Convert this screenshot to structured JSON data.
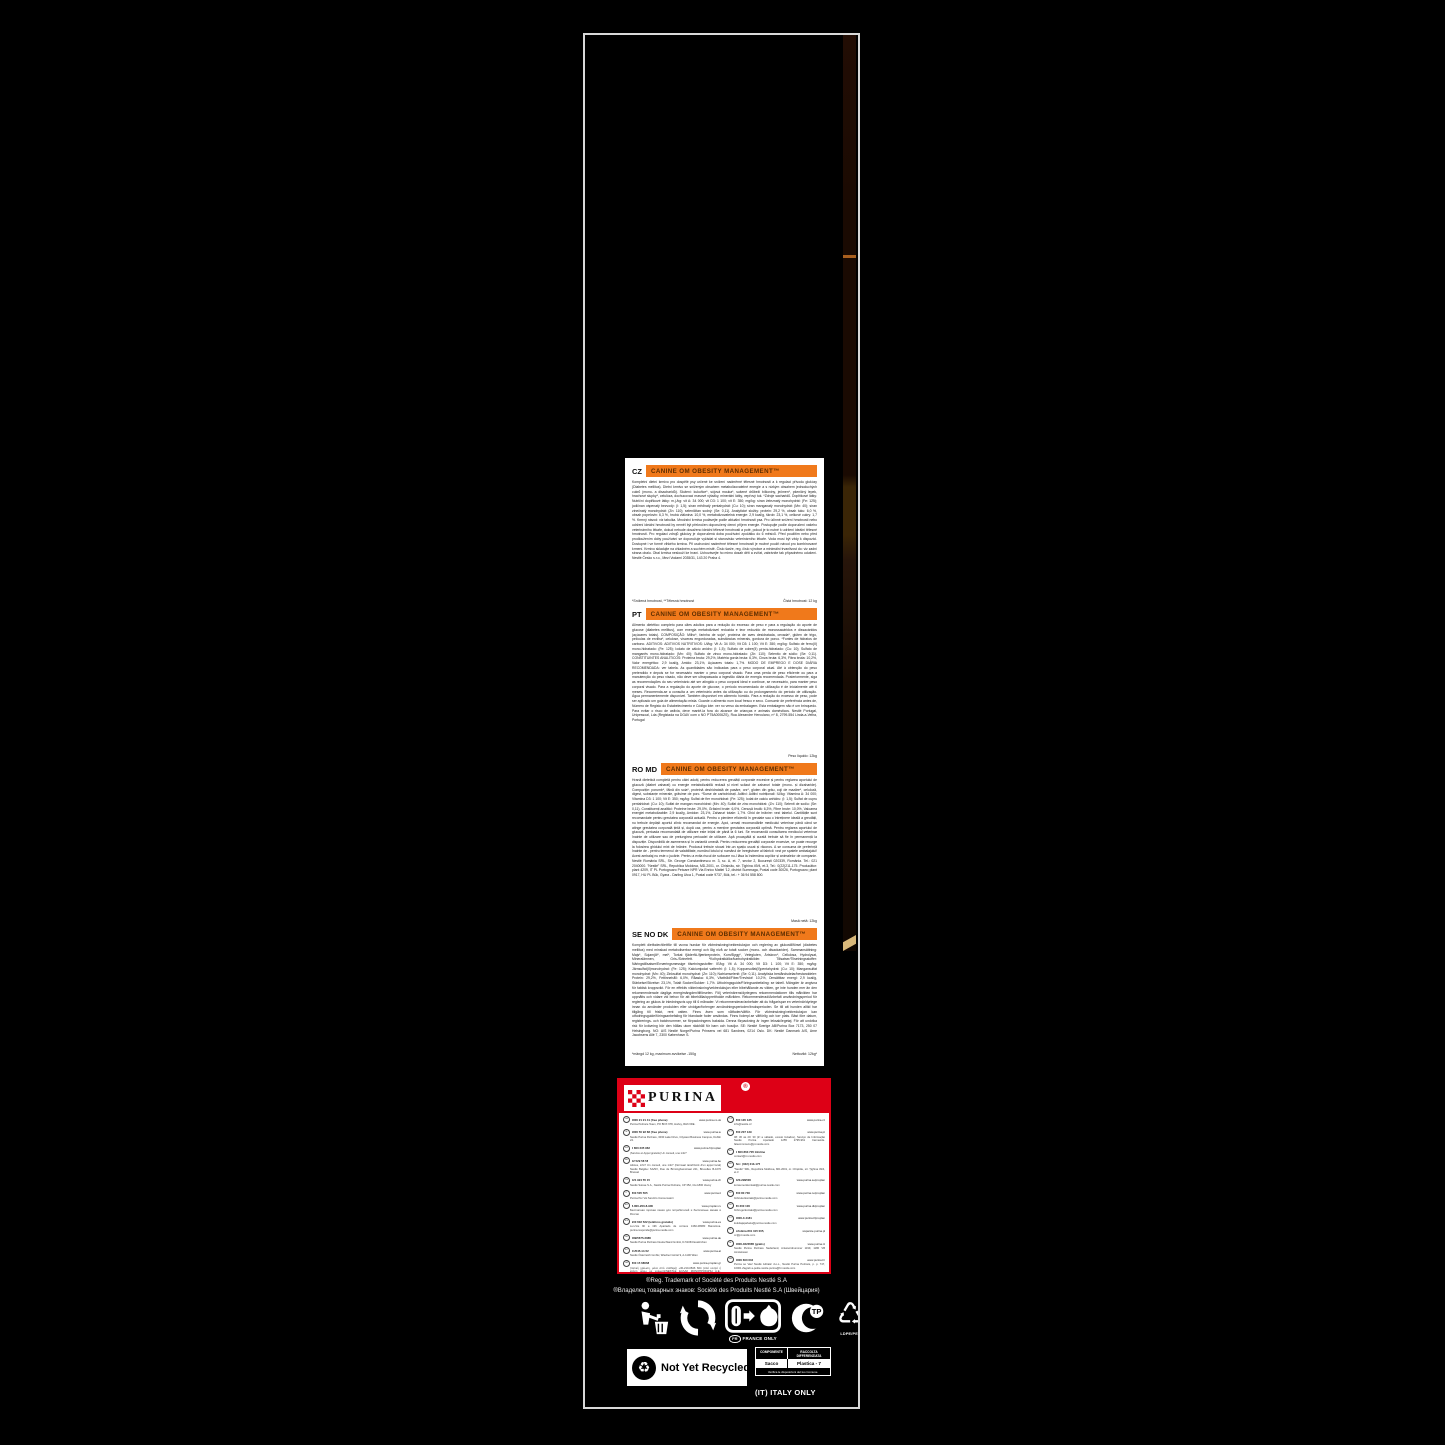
{
  "colors": {
    "accent_orange": "#f0791b",
    "brand_red": "#dd0016",
    "edge_brown": "#3a2506",
    "edge_tan": "#d9b87a"
  },
  "package": {
    "sections": [
      {
        "code": "CZ",
        "title": "CANINE OM OBESITY MANAGEMENT™",
        "body": "Kompletní dietní krmivo pro dospělé psy určené ke snížení nadměrné tělesné hmotnosti a k regulaci přívodu glukózy (Diabetes mellitus). Dietní krmivo se sníženým obsahem metabolizovatelné energie a s nízkým obsahem jednoduchých cukrů (mono- a disacharidů). Složení: kukuřice*, sójová mouka*, sušené drůbeží bílkoviny, ječmen*, pšeničný lepek, hrachové slupky*, celulóza, dochucovací masové výtažky, minerální látky, vepřový tuk. *Zdroje sacharidů. Doplňkové látky: Nutriční doplňkové látky: m.j./kg: vit A: 34 000; vit D3: 1 100; vit E: 350; mg/kg: síran železnatý monohydrát: (Fe: 125); jodičnan vápenatý bezvodý: (I: 1,5); síran měďnatý pentahydrát: (Cu: 10); síran manganatý monohydrát: (Mn: 40); síran zinečnatý monohydrát: (Zn: 110); seleničitan sodný: (Se: 0,11). Analytické složky: protein: 29,2 %, obsah tuku: 6,0 %, obsah popelovin: 6,3 %, hrubá vláknina: 10,0 %, metabolizovatelná energie: 2,9 kcal/g, škrob: 23,1 %, celkové cukry: 1,7 %. Krmný návod: viz tabulka. Množství krmiva podávejte podle aktuální hmotnosti psa. Pro účinné snížení hmotnosti nebo udržení ideální hmotnosti by neměl být překročen doporučený denní příjem energie. Postupujte podle doporučení vašeho veterinárního lékaře, dokud nebude dosaženo ideální tělesné hmotnosti a poté, pokud je to nutné k udržení ideální tělesné hmotnosti. Pro regulaci zdrojů glukózy je doporučená doba používání zpočátku do 6 měsíců. Před použitím nebo před prodloužením doby používání se doporučuje vyžádat si stanovisko veterinárního lékaře. Voda musí být vždy k dispozici. Dostupné i ve formě vlhkého krmiva. Při uschování nadměrné tělesné hmotnosti je možné použít návod pro kombinované krmení. Krmivo skladujte na chladném a suchém místě. Číslo šarže, reg. číslo výrobce a minimální trvanlivost do: viz zadní strana obalu. Obal krmiva neslouží ke hraní. Uchovávejte ho mimo dosah dětí a zvířat, zabráníte tak případnému udušení. Nestlé Česko s.r.o., Mezi Vodami 2035/31, 143 20 Praha 4.",
        "footnote": "*Snížená hmotnost, **Tělesná hmotnost",
        "weight": "Čistá hmotnost: 12 kg"
      },
      {
        "code": "PT",
        "title": "CANINE OM OBESITY MANAGEMENT™",
        "body": "Alimento dietético completo para cães adultos para a redução do excesso de peso e para a regulação do aporte de glucose (diabetes mellitus), com energia metabolizável reduzida e teor reduzido de monossacáridos e dissacáridos (açúcares totais). COMPOSIÇÃO: Milho*, farinha de soja*, proteína de aves desidratada, cevada*, glúten de trigo, películas de ervilha*, celulose, vísceras engorduradas, substâncias minerais, gordura de porco. *Fontes de hidratos de carbono. ADITIVOS: ADITIVOS NUTRITIVOS: UI/kg: Vit A: 34 000; Vit D3: 1 100; Vit E: 350; mg/kg: Sulfato de ferro(II) mono-hidratado: (Fe: 125); Iodato de cálcio anidro: (I: 1,5); Sulfato de cobre(II) penta-hidratado: (Cu: 10); Sulfato de manganês mono-hidratado: (Mn: 40); Sulfato de zinco mono-hidratado: (Zn: 110); Selenito de sódio: (Se: 0,11). CONSTITUINTES ANALÍTICOS: Proteína bruta: 29,2%, Matéria gorda bruta: 6,3%, Cinza bruta: 6,3%, Fibra bruta: 10,2%, Valor energético: 2,9 kcal/g, Amido: 23,1%, Açúcares totais: 1,7%. MODO DE EMPREGO E DOSE DIÁRIA RECOMENDADA: ver tabela. As quantidades são indicadas para o peso corporal atual. Até à obtenção do peso pretendido e depois se for necessário manter o peso corporal visado. Para uma perda de peso eficiente ou para a manutenção do peso visado, não deve ser ultrapassada a ingestão diária de energia recomendada. Posteriormente, siga as recomendações do seu veterinário até ser atingido o peso corporal ideal e continue, se necessário, para manter peso corporal visado. Para a regulação do aporte de glucose, o período recomendado de utilização é de inicialmente até 6 meses. Recomenda-se a consulta a um veterinário antes da utilização ou do prolongamento do período de utilização. Água permanentemente disponível. Também disponível em alimento húmido. Para a redução do excesso de peso, pode ser aplicado um guia de alimentação mista. Guarde o alimento num local fresco e seco. Consumir de preferência antes de, Número de Registo do Estabelecimento e Código lote: ver no verso da embalagem. Esta embalagem não é um brinquedo. Para evitar o risco de asfixia, deve mantê-la fora do alcance de crianças e animais domésticos. Nestlé Portugal, Unipessoal, Lda (Registada na DGAV com o NO PT5A0006ZS), Rua Alexandre Herculano, nº 8, 2799-554 Linda-a-Velha, Portugal",
        "footnote": "",
        "weight": "Peso líquido: 12kg"
      },
      {
        "code": "RO MD",
        "title": "CANINE OM OBESITY MANAGEMENT™",
        "body": "Hrană dietetică completă pentru câini adulți, pentru reducerea greutății corporale excesive și pentru reglarea aportului de glucoză (diabet zaharat) cu energie metabolizabilă redusă și nivel scăzut de zaharuri totale (mono- și dizaharide). Compoziție: porumb*, făină din soia*, proteină deshidratată de pasăre, orz*, gluten din grâu, coji de mazăre*, celuloză, digest, substanțe minerale, grăsime de porc. *Surse de carbohidrați. Aditivi: Aditivi nutriționali: IU/kg: Vitamina A: 34 000; Vitamina D3: 1 100; Vit E: 350; mg/kg: Sulfat de fier monohidrat: (Fe: 125); Iodat de calciu anhidru: (I: 1,5); Sulfat de cupru pentahidrat: (Cu: 10); Sulfat de mangan monohidrat: (Mn: 40); Sulfat de zinc monohidrat: (Zn: 110); Selenit de sodiu: (Se: 0,11). Constituenți analitici: Proteine brute: 29,0%, Grăsimi brute: 6,0%, Cenușă brută: 6,3%, Fibre brute: 10,0%, Valoarea energiei metabolizabile: 2,9 kcal/g, Amidon: 23,1%, Zaharuri totale: 1,7%. Ghid de hrănire: vezi tabelul. Cantitățile sunt recomandate pentru greutatea corporală actuală. Pentru o pierdere eficientă în greutate sau o întreținere ideală a greutății, nu trebuie depășit aportul zilnic recomandat de energie. Apoi, urmați recomandările medicului veterinar până când se atinge greutatea corporală țintă și, după caz, pentru a menține greutatea corporală optimă. Pentru reglarea aportului de glucoză, perioada recomandată de utilizare este inițial de până la 6 luni. Se recomandă consultarea medicului veterinar înainte de utilizare sau de prelungirea perioadei de utilizare. Apă proaspătă și curată trebuie să fie în permanență la dispoziție. Disponibilă de asemenea și în variantă umedă. Pentru reducerea greutății corporale excesive, se poate recurge la folosirea ghidului mixt de hrănire. Produsul trebuie stocat într-un spațiu uscat și răcoros. A se consuma de preferință înainte de - pentru termenul de valabilitate, numărul lotului și numărul de înregistrare al fabricii: vezi pe spatele ambalajului! Acest ambalaj nu este o jucărie. Pentru a evita riscul de sufocare nu-l lăsa la îndemâna copiilor și animalelor de companie. Nestlé România SRL, Str. George Constantinescu nr. 3, sc. A, et. 7, sector 2, București 020339, România. Tel.: 021 2040000. \"Nestlé\" SRL, Republica Moldova, MD-2001, or. Chișinău, str. Țighina 49/4, et.3, Tel.: 0(22)211-175. Producător: plant 4209, IT PL Portogruaro Petcare NPR Via Enrico Mattei '12, district Summaga, Postal code 30026, Portogruaro; plant 0917, HU PL Bük, Gyara - Darling Utca 1, Postal code 9737, Bük, tel.: + 36 94 558 800.",
        "footnote": "",
        "weight": "Masă netă: 12kg"
      },
      {
        "code": "SE NO DK",
        "title": "CANINE OM OBESITY MANAGEMENT™",
        "body": "Komplett dietfoder/diettfôr till vuxna hundar för viktminskning/vektreduksjon och reglering av glukostillförsel (diabetes mellitus) med minskad metaboliserbar energi och låg nivå av totalt socker (mono- och disackarider). Sammansättning: Majs*, Sojamjöl*, mel*, Torkat fjäderfä-/fjærkreprotein, Korn/Bygg*, Vetegluten, Ärtskrov*, Cellulosa, Hydrolysat, Mineralämnen, Gris-/Svinefett. *Kolhydratkällor/karbohydratkilder. Tillsatser/Tilsetningsstoffer: Näringstillsatser/Ernæringsmessige tilsetningsstoffer: IE/kg: Vit A: 34 000; Vit D3: 1 100; Vit E: 350; mg/kg: Järnsulfat(II)monohydrat: (Fe: 125); Kalciumjodat vattenfri: (I: 1,5); Kopparsulfat(II)pentahydrat: (Cu: 10); Mangansulfat monohydrat: (Mn: 40); Zinksulfat monohydrat: (Zn: 110); Natriumselenit: (Se: 0,11). Analytiska beståndsdelar/bestanddeler: Protein: 29,2%, Fettinnehåll: 6,0%, Råaska: 6,3%, Växttråd/Fiber/Trevlstof: 10,2%, Omsättbar energi: 2,9 kcal/g, Stärkelse/Stivelse: 23,1%, Totalt Socker/Sukker: 1,7%. Utfodringsguide/Fôringsanbefaling: se tabell. Mängder är angivna för faktisk kroppsvikt. För en effektiv viktminskning/vektreduksjon eller bibehållande av vikten, ge inte hunden mer än den rekommenderade dagliga energimängden/tilförselen. Följ veterinärens/dyrlegens rekommendationer tills målvikten har uppnåtts och vidare vid behov för att bibehålla/opprettholde målvikten. Rekommenderad/Anbefalt användningsperiod för reglering av glukos är inledningsvis upp till 6 månader. Vi rekommenderar/anbefaler att du frågar/spør en veterinär/dyrlege innan du använder produkten eller utvidgar/forlenger användningsperioden/bruksperioden. Se till att hunden alltid har tillgång till friskt, rent vatten. Finns även som våtfoder/våtfôr. För viktminskning/vektreduksjon kan utfodringsguide/fôringsanbefaling för blandade foder användas. Finns foderpl.se våtfôrlig och torr plats. Bäst före datum, registrerings- och batchnummer, se förpackningens baksida. Denna förpackning är ingen leksak/legetøj. För att undvika risk för kvävning bör den hållas utom räckhåll för barn och husdjur. SE: Nestlé Sverige AB/Purina Box 7173, 250 07 Helsingborg. NO: A/S Nestlé Norge/Purina Prinsens vei 681 Sandnes, 0214 Oslo. DK: Nestlé Danmark A/S, Arne Jacobsens Allé 7, 2300 København S.",
        "footnote": "*mängd 12 kg, maximum avvikelse -150g",
        "weight": "Nettovikt: 12kg*"
      }
    ],
    "brand": {
      "name": "PURINA",
      "reg": "®"
    },
    "contacts_left": [
      {
        "code": "GB",
        "phone": "0800 21 21 41 (free phone)",
        "site": "www.purina.co.uk",
        "lines": "Purina PetCare Team, PO BOX 678, Horley, RH6 6DE."
      },
      {
        "code": "IE",
        "phone": "1800 50 92 68 (free phone)",
        "site": "www.purina.ie",
        "lines": "Nestlé Purina PetCare, 3030 Lake Drive, Citywest Business Campus, Dublin 24."
      },
      {
        "code": "FR",
        "phone": "0 800 235 962",
        "site": "www.purina.fr/proplan",
        "lines": "(Service et Appel gratuits) Un conseil, une info?"
      },
      {
        "code": "BE",
        "phone": "02 529 58 58",
        "site": "www.purina.be",
        "lines": "Advies, info? Un conseil, une info? (Normaal tarief/Coût d'un appel local) Nestlé Belgilux SA/NV, Rue de Birminghamstraat 221, Bruxelles B-1070 Brussel"
      },
      {
        "code": "CH",
        "phone": "021 924 55 15",
        "site": "www.purina.ch",
        "lines": "Nestlé Suisse S.A., Nestlé Purina PetCare, CP 352, CH-1800 Vevey"
      },
      {
        "code": "IT",
        "phone": "800 505 505",
        "site": "www.purina.it",
        "lines": "Purina Per Voi Servizio Consumatori"
      },
      {
        "code": "RU",
        "phone": "8-800-200-8-900",
        "site": "www.proplan.ru",
        "lines": "Бесплатная горячая линия для потребителей и бесплатные звонки в России"
      },
      {
        "code": "ES",
        "phone": "900 602 522 (teléfono gratuito)",
        "site": "www.purina.es",
        "lines": "Lun-Vie 9h a 19h Apartado de correos 1360-08080 Barcelona. purina.responde@purina.nestle.com"
      },
      {
        "code": "DE",
        "phone": "089/5675.3088",
        "site": "www.purina.de",
        "lines": "Nestlé Purina PetCare Deutschland GmbH, D-51063 Euskirchen"
      },
      {
        "code": "AT",
        "phone": "01/545-14-52",
        "site": "www.purina.at",
        "lines": "Nestlé Österreich GmbH, Wiedner Gürtel 9, A-1100 Wien"
      },
      {
        "code": "GR",
        "phone": "800 15 68068",
        "site": "www.purina-proplan.gr",
        "lines": "(τοπική χρέωση, μόνο από σταθερό) +30-210-0846 824 (από κινητό ή κλήση μέσω με χρέωση)/NESTLÉ ΕΛΛΑΣ ΜΟΝΟΠΡΟΣΩΠΗ Α.Ε., Πατρόκλου 4, 151 25 Μαρούσι, Ελλάδα"
      }
    ],
    "contacts_right": [
      {
        "code": "CZ",
        "phone": "800 135 135",
        "site": "www.purina.cz",
        "lines": "info@nestle.cz"
      },
      {
        "code": "PT",
        "phone": "800 207 139",
        "site": "www.purina.pt",
        "lines": "08: 30 às 20: 30 (2ª a sábado, exceto feriados), Serviço de Informação Nestlé Purina Apartado 1255 2795-961 Carnaxide. falecomnosco@pt.nestle.com"
      },
      {
        "code": "RO",
        "phone": "0 800 863 705 Infoline",
        "site": "",
        "lines": "contact@ro.nestle.com"
      },
      {
        "code": "MD",
        "phone": "Tel.: (022) 213-175",
        "site": "",
        "lines": "\"Nestlé\" SRL, Republica Moldova, MD-2001, or. Chișinău, str. Țighina 49/4, et.3"
      },
      {
        "code": "SE",
        "phone": "020-299500",
        "site": "www.purina.se/proplan",
        "lines": "konsumentkontakt@purina.nestle.com"
      },
      {
        "code": "NO",
        "phone": "800 80 730",
        "site": "www.purina.no/proplan",
        "lines": "forbrukerkontakt@purina.nestle.com"
      },
      {
        "code": "DK",
        "phone": "80 300 100",
        "site": "www.purina.dk/proplan",
        "lines": "forbrugerkontakt@purina.nestle.com"
      },
      {
        "code": "FI",
        "phone": "0800-0-4181",
        "site": "www.purina.fi/proplan",
        "lines": "kuluttajapalvelu@purina.nestle.com"
      },
      {
        "code": "PL",
        "phone": "Infolinia 801 315 005,",
        "site": "wsparcie.purina.pl",
        "lines": "cc@pl.nestle.com"
      },
      {
        "code": "NL",
        "phone": "0800-0223585 (gratis)",
        "site": "www.purina.nl",
        "lines": "Nestlé Purina PetCare Nederland, Antwoordnummer 1199, 1180 VB Amstelveen"
      },
      {
        "code": "HR",
        "phone": "0800 600 604",
        "site": "www.purina.hr",
        "lines": "Purina se Vas! Nestlé Adriatic d.o.o., Nestlé Purina PetCare, p. p. 747, 10001 Zagreb a-petite.nestle.purina@hr.nestle.com"
      },
      {
        "code": "SK",
        "phone": "0800 202 42",
        "site": "",
        "lines": "info@sk.nestle.com"
      },
      {
        "code": "TR",
        "phone": "444 31 90/0850 211 02 16",
        "site": "www.purina.com.tr/proplan",
        "lines": "Ücretsiz Tüketici Danışma Hattımız"
      },
      {
        "code": "LV",
        "phone": "67 508 056",
        "site": "www.proplan.lv",
        "lines": "info@lv.nestle.com"
      }
    ],
    "trademark_line1": "®Reg. Trademark of Société des Produits Nestlé S.A",
    "trademark_line2": "®Владелец товарных знаков: Société des Produits Nestlé S.A (Швейцария)",
    "france_only": {
      "code": "FR",
      "label": "FRANCE ONLY"
    },
    "ldpe_label": "LDPE/PET",
    "not_yet_recycled": "Not Yet Recycled",
    "italy_table": {
      "header": [
        "COMPONENTE",
        "RACCOLTA DIFFERENZIATA"
      ],
      "row": [
        "Sacco",
        "Plastica - 7"
      ],
      "footer": "Verifica le disposizioni del tuo Comune."
    },
    "italy_only": "(IT) ITALY ONLY"
  }
}
